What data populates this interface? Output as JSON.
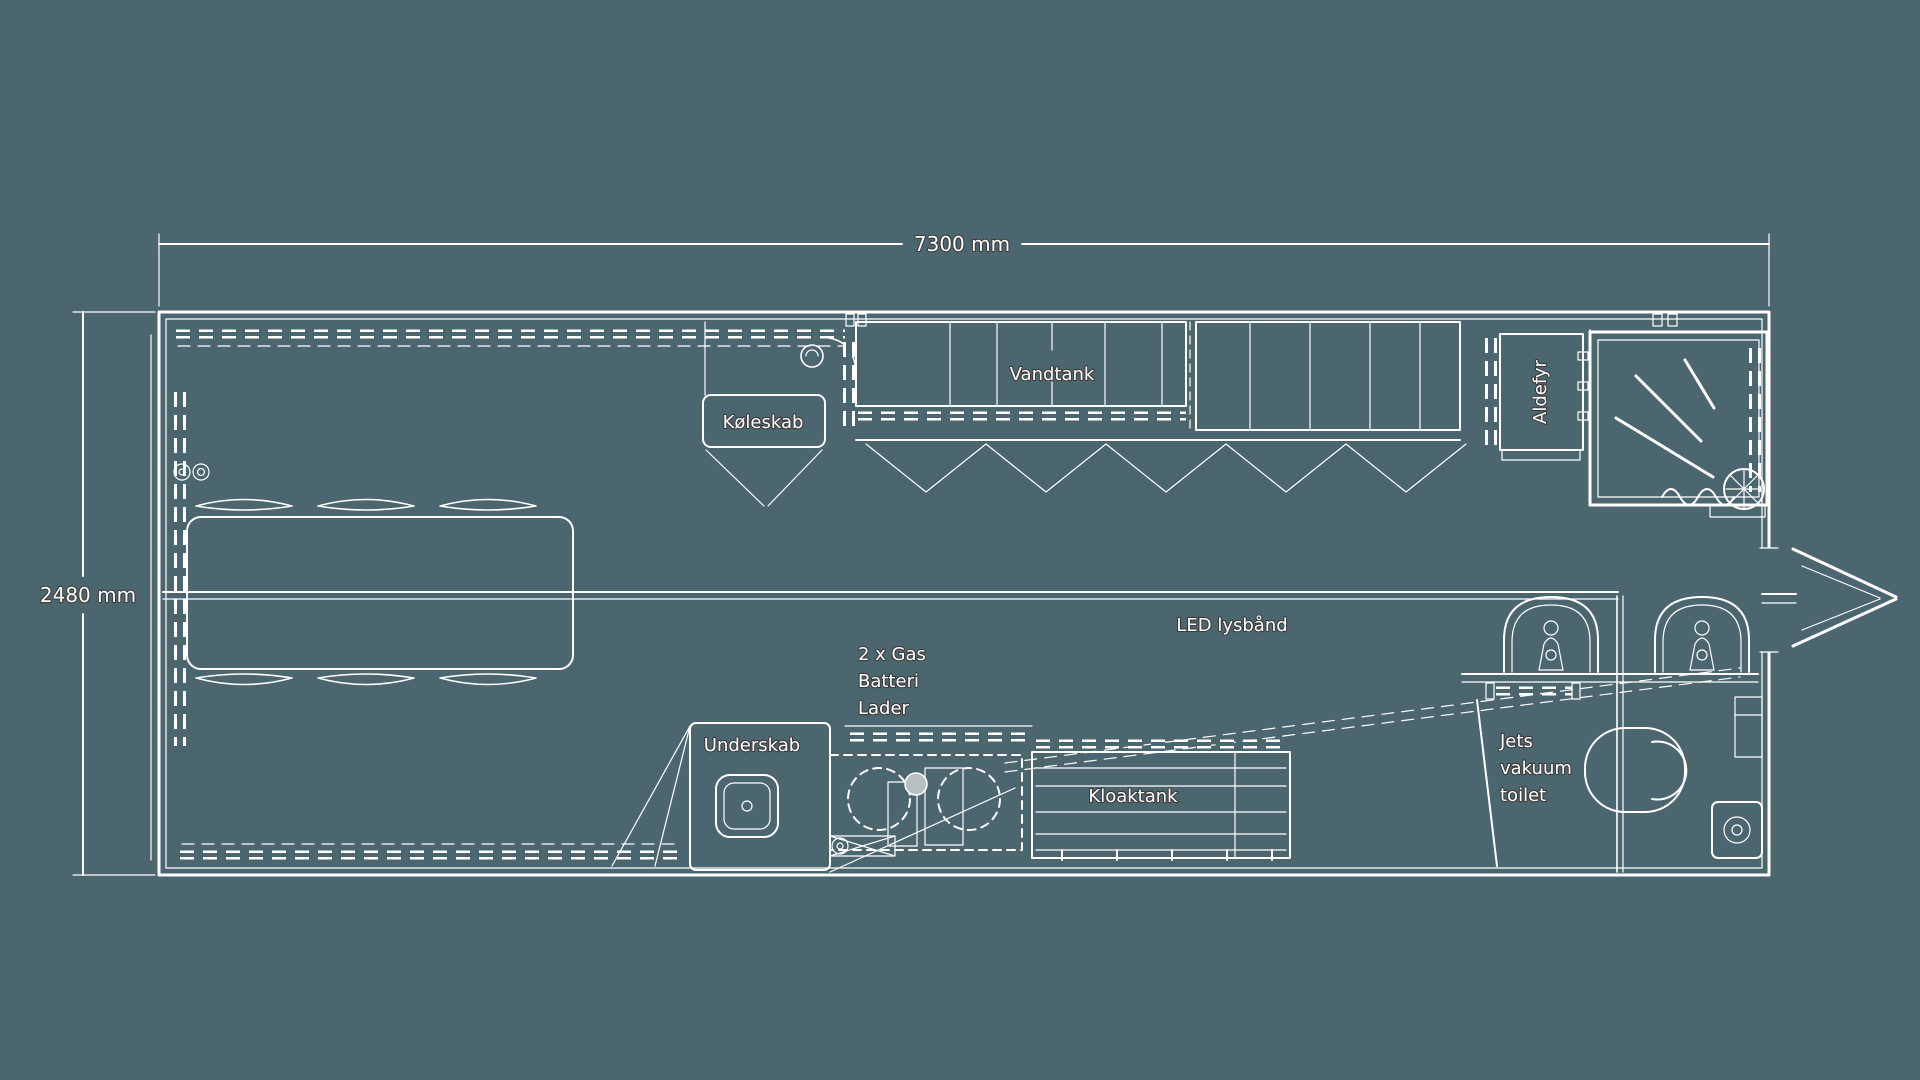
{
  "dimensions": {
    "width_label": "7300 mm",
    "height_label": "2480 mm"
  },
  "labels": {
    "fridge": "Køleskab",
    "water_tank": "Vandtank",
    "heater": "Aldefyr",
    "led_strip": "LED lysbånd",
    "gas_battery": [
      "2 x Gas",
      "Batteri",
      "Lader"
    ],
    "under_cabinet": "Underskab",
    "sewage_tank": "Kloaktank",
    "vacuum_toilet": [
      "Jets",
      "vakuum",
      "toilet"
    ]
  },
  "colors": {
    "background": "#4C6670",
    "line": "#FFFFFF",
    "text_outline": "#3C3C3C",
    "fan_fill": "#B9C0C2"
  }
}
